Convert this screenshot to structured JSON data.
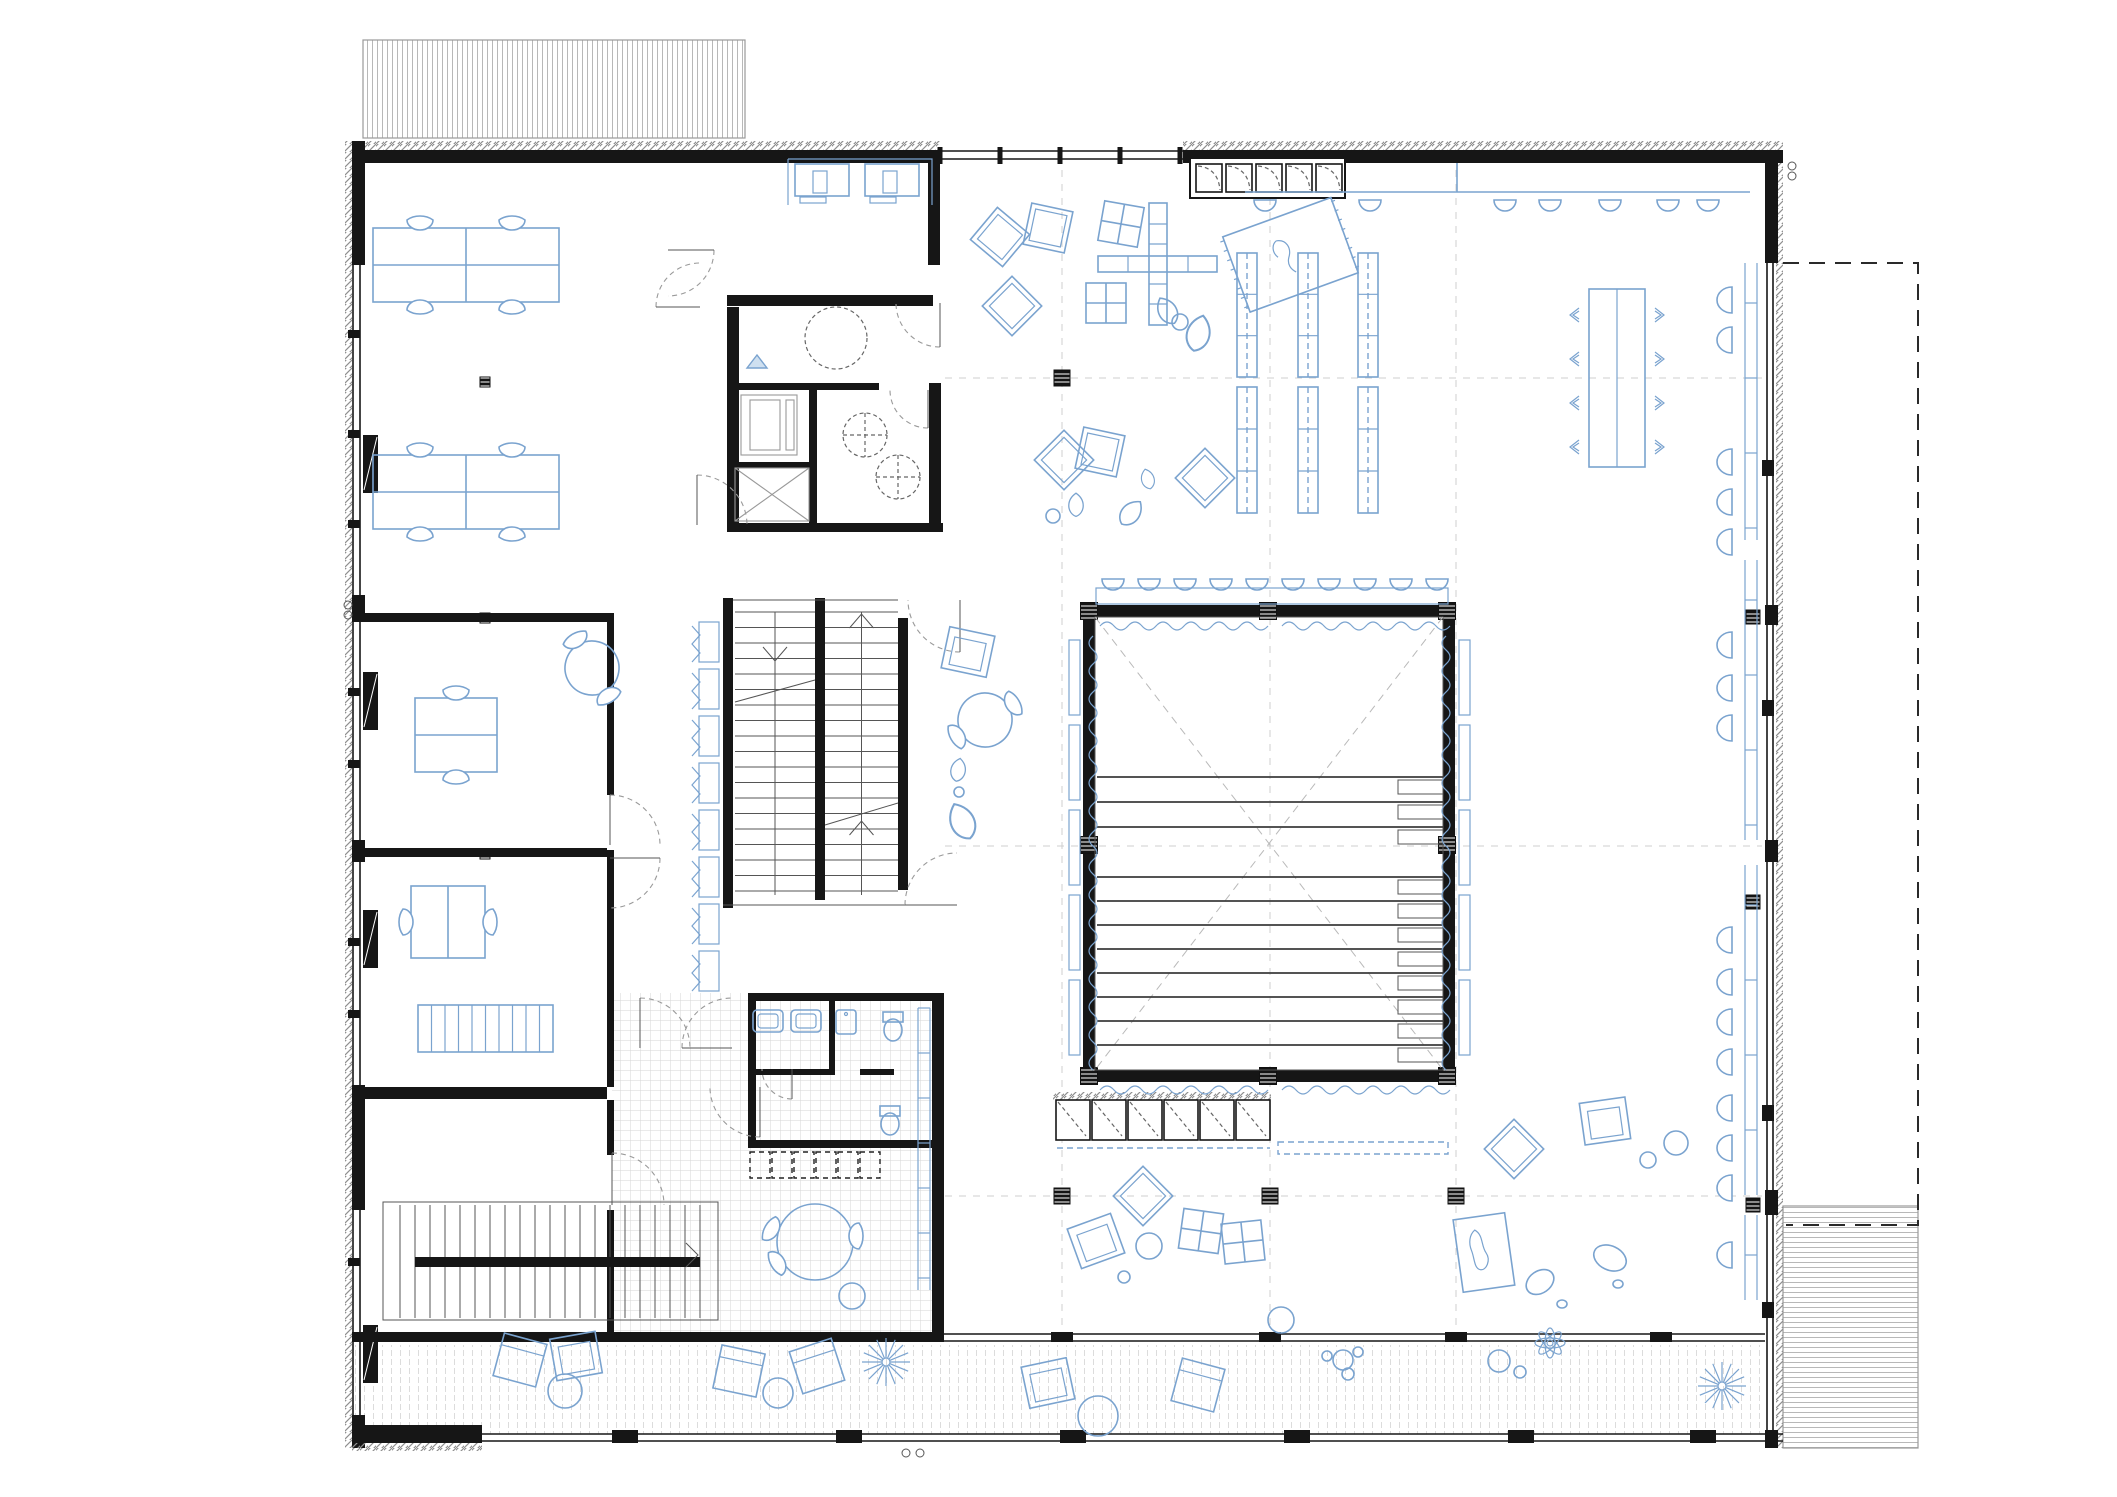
{
  "meta": {
    "drawing_type": "architectural floor plan",
    "text_on_drawing": "none",
    "style": "black walls, blue furniture line-work on white"
  },
  "colors": {
    "wall": "#161616",
    "furniture_line": "#7aa3cf",
    "hatch": "#8f8f8f",
    "tile": "#d6d6d6",
    "deck": "#dcdcdc",
    "grid": "#cfcfcf"
  },
  "zones": [
    {
      "id": "canopy-north",
      "bbox": [
        363,
        40,
        382,
        98
      ]
    },
    {
      "id": "classroom-northwest",
      "bbox": [
        363,
        163,
        340,
        450
      ]
    },
    {
      "id": "computer-room",
      "bbox": [
        712,
        163,
        228,
        140
      ]
    },
    {
      "id": "elevator-core",
      "bbox": [
        727,
        383,
        90,
        147
      ]
    },
    {
      "id": "wc-accessible",
      "bbox": [
        817,
        383,
        120,
        147
      ]
    },
    {
      "id": "meeting-room-a",
      "bbox": [
        363,
        623,
        250,
        225
      ]
    },
    {
      "id": "meeting-room-b",
      "bbox": [
        363,
        858,
        250,
        229
      ]
    },
    {
      "id": "storage-room-southwest",
      "bbox": [
        363,
        1100,
        245,
        100
      ]
    },
    {
      "id": "stair-southwest",
      "bbox": [
        383,
        1202,
        335,
        130
      ]
    },
    {
      "id": "main-staircase",
      "bbox": [
        723,
        598,
        185,
        310
      ]
    },
    {
      "id": "central-corridor",
      "bbox": [
        613,
        618,
        110,
        470
      ]
    },
    {
      "id": "cafe",
      "bbox": [
        612,
        1148,
        320,
        184
      ]
    },
    {
      "id": "wc-south",
      "bbox": [
        748,
        993,
        192,
        155
      ]
    },
    {
      "id": "library-north",
      "bbox": [
        945,
        200,
        820,
        400
      ]
    },
    {
      "id": "auditorium",
      "bbox": [
        1083,
        605,
        372,
        477
      ]
    },
    {
      "id": "lounge-south",
      "bbox": [
        945,
        1085,
        820,
        250
      ]
    },
    {
      "id": "lounge-east",
      "bbox": [
        1475,
        620,
        290,
        440
      ]
    },
    {
      "id": "terrace-south",
      "bbox": [
        352,
        1345,
        1413,
        92
      ]
    },
    {
      "id": "ramp-southeast",
      "bbox": [
        1783,
        1206,
        135,
        242
      ]
    },
    {
      "id": "plot-boundary-east",
      "bbox": [
        1783,
        263,
        135,
        962
      ]
    }
  ],
  "grid": {
    "vx": [
      1062,
      1270,
      1456
    ],
    "hy": [
      378,
      846,
      1196
    ],
    "xr": [
      945,
      1762
    ],
    "yr": [
      170,
      1335
    ]
  },
  "columns": {
    "large": [
      [
        1062,
        378
      ],
      [
        1062,
        1196
      ],
      [
        1270,
        1196
      ],
      [
        1456,
        1196
      ]
    ],
    "mini": [
      [
        485,
        382
      ],
      [
        485,
        618
      ],
      [
        485,
        854
      ]
    ],
    "facade": [
      [
        1753,
        617
      ],
      [
        1753,
        902
      ],
      [
        1753,
        1205
      ]
    ],
    "hall": [
      [
        1089,
        611
      ],
      [
        1268,
        611
      ],
      [
        1447,
        611
      ],
      [
        1089,
        845
      ],
      [
        1447,
        845
      ],
      [
        1089,
        1076
      ],
      [
        1268,
        1076
      ],
      [
        1447,
        1076
      ]
    ]
  },
  "auditorium": {
    "inner": [
      1095,
      617,
      348,
      453
    ],
    "rows_y": [
      777,
      802,
      827,
      877,
      901,
      925,
      949,
      973,
      997,
      1021,
      1045
    ],
    "row_x": [
      1097,
      1443
    ],
    "step": [
      1398,
      45,
      14
    ],
    "track": [
      1096,
      588,
      352,
      16
    ],
    "pendant_y": 579,
    "pendant_xs": [
      1113,
      1149,
      1185,
      1221,
      1257,
      1293,
      1329,
      1365,
      1401,
      1437
    ],
    "panel_ys": [
      640,
      725,
      810,
      895,
      980
    ],
    "panel_left_x": 1069,
    "panel_right_x": 1459,
    "curtains_h": [
      [
        1100,
        626,
        158
      ],
      [
        1282,
        626,
        158
      ],
      [
        1100,
        1090,
        158
      ],
      [
        1282,
        1090,
        158
      ]
    ],
    "curtains_v": [
      [
        1093,
        636,
        424
      ],
      [
        1446,
        636,
        424
      ]
    ],
    "cabinets": {
      "x": 1056,
      "y": 1100,
      "n": 6,
      "w": 36,
      "h": 40
    },
    "cabinet_hatch": [
      1053,
      1092,
      218,
      8
    ],
    "bench_dashed": [
      1278,
      1142,
      170,
      12
    ],
    "bench_line": [
      1057,
      1148,
      213
    ]
  },
  "stairs": {
    "main": {
      "lx": 735,
      "mx1": 815,
      "mx2": 825,
      "rx": 898,
      "y0": 612,
      "y1": 895,
      "step": 15.5
    },
    "south": {
      "x0": 400,
      "x1": 700,
      "y0": 1205,
      "y1": 1318,
      "step": 15,
      "rail": [
        415,
        1257,
        285,
        10
      ],
      "frame": [
        383,
        1202,
        335,
        118
      ]
    }
  },
  "library": {
    "shelf_xs": [
      1247,
      1308,
      1368
    ],
    "shelf_segs": [
      [
        253,
        124
      ],
      [
        387,
        126
      ]
    ],
    "shelf_w": 20,
    "lockers": {
      "x": 1196,
      "y": 164,
      "n": 5,
      "w": 26,
      "h": 28,
      "gap": 4,
      "frame": [
        1190,
        158,
        155,
        40
      ]
    },
    "counter": {
      "y": 192,
      "x0": 1245,
      "x1": 1750,
      "stub_x": 1457,
      "pendant_xs": [
        1265,
        1370,
        1505,
        1550,
        1610,
        1668,
        1708
      ],
      "pendant_y": 200
    },
    "colonnade": {
      "y1": 151,
      "y2": 159,
      "x0": 940,
      "x1": 1183,
      "ticks": [
        940,
        1000,
        1060,
        1120,
        1180
      ]
    }
  },
  "window_bench": {
    "x": 1727,
    "ys": [
      300,
      340,
      462,
      502,
      542,
      645,
      688,
      728,
      940,
      982,
      1022,
      1062,
      1108,
      1148,
      1188,
      1255
    ]
  },
  "window_counter": {
    "x1": 1745,
    "x2": 1757,
    "segs": [
      [
        263,
        540
      ],
      [
        560,
        840
      ],
      [
        865,
        1195
      ],
      [
        1215,
        1300
      ]
    ]
  },
  "corridor_bench": {
    "x": 699,
    "y0": 622,
    "n": 8,
    "step": 47
  },
  "cubbies": {
    "x": 750,
    "y": 1152,
    "n": 6,
    "w": 20,
    "h": 26,
    "gap": 2
  },
  "doors": [
    [
      700,
      307,
      44,
      180,
      270
    ],
    [
      940,
      303,
      44,
      90,
      180
    ],
    [
      928,
      390,
      38,
      90,
      180
    ],
    [
      697,
      525,
      50,
      270,
      360
    ],
    [
      960,
      600,
      52,
      90,
      180
    ],
    [
      957,
      905,
      52,
      180,
      270
    ],
    [
      610,
      845,
      50,
      270,
      360
    ],
    [
      610,
      858,
      50,
      0,
      90
    ],
    [
      612,
      1205,
      52,
      270,
      360
    ],
    [
      760,
      1087,
      50,
      90,
      180
    ],
    [
      792,
      1069,
      30,
      90,
      180
    ],
    [
      668,
      250,
      46,
      0,
      90
    ],
    [
      640,
      1048,
      50,
      270,
      360
    ],
    [
      732,
      1048,
      50,
      180,
      270
    ]
  ],
  "marks": {
    "circle_pairs": [
      [
        1792,
        166
      ],
      [
        348,
        605
      ],
      [
        906,
        1453
      ]
    ],
    "triangle": [
      757,
      368,
      20,
      13
    ],
    "dashed_circle": [
      836,
      338,
      31
    ],
    "wc_circles": [
      [
        865,
        435,
        22
      ],
      [
        898,
        477,
        22
      ]
    ]
  },
  "furniture": {
    "items": [
      {
        "t": "table4",
        "x": 466,
        "y": 265
      },
      {
        "t": "table4",
        "x": 466,
        "y": 492
      },
      {
        "t": "pcbay",
        "x": 860,
        "y": 183
      },
      {
        "t": "table2v",
        "x": 456,
        "y": 735
      },
      {
        "t": "round2",
        "x": 592,
        "y": 668,
        "rad": 27,
        "r": -30
      },
      {
        "t": "table2h",
        "x": 448,
        "y": 922
      },
      {
        "t": "shelf10",
        "x": 485,
        "y": 1028
      },
      {
        "t": "round3",
        "x": 815,
        "y": 1242,
        "rad": 38
      },
      {
        "t": "stool",
        "x": 852,
        "y": 1296,
        "rad": 13
      },
      {
        "t": "sink",
        "x": 768,
        "y": 1021
      },
      {
        "t": "sink",
        "x": 806,
        "y": 1021
      },
      {
        "t": "sinksm",
        "x": 846,
        "y": 1022
      },
      {
        "t": "toilet",
        "x": 893,
        "y": 1026
      },
      {
        "t": "toilet",
        "x": 890,
        "y": 1120
      },
      {
        "t": "diamond",
        "x": 1000,
        "y": 237,
        "r": 40
      },
      {
        "t": "diamond",
        "x": 1048,
        "y": 228,
        "r": 12
      },
      {
        "t": "diamond",
        "x": 1012,
        "y": 306,
        "r": 45
      },
      {
        "t": "diamond",
        "x": 1064,
        "y": 460,
        "r": 45
      },
      {
        "t": "diamond",
        "x": 1100,
        "y": 452,
        "r": 12
      },
      {
        "t": "diamond",
        "x": 1205,
        "y": 478,
        "r": 45
      },
      {
        "t": "blob",
        "x": 1168,
        "y": 312,
        "r": -30
      },
      {
        "t": "blob",
        "x": 1198,
        "y": 335,
        "r": 15,
        "s": 1.25
      },
      {
        "t": "blob",
        "x": 1076,
        "y": 506,
        "s": 0.8
      },
      {
        "t": "blob",
        "x": 1130,
        "y": 514,
        "r": 40
      },
      {
        "t": "blob",
        "x": 1148,
        "y": 480,
        "r": -15,
        "s": 0.7
      },
      {
        "t": "blob",
        "x": 958,
        "y": 771,
        "r": 10,
        "s": 0.8
      },
      {
        "t": "blob",
        "x": 963,
        "y": 823,
        "r": -25,
        "s": 1.3
      },
      {
        "t": "circle",
        "x": 1180,
        "y": 322,
        "rad": 8
      },
      {
        "t": "circle",
        "x": 1053,
        "y": 516,
        "rad": 7
      },
      {
        "t": "circle",
        "x": 959,
        "y": 792,
        "rad": 5
      },
      {
        "t": "armchair",
        "x": 968,
        "y": 652,
        "r": 12
      },
      {
        "t": "round2",
        "x": 985,
        "y": 720,
        "rad": 27,
        "r": 60
      },
      {
        "t": "cross",
        "x": 1158,
        "y": 264
      },
      {
        "t": "quad",
        "x": 1121,
        "y": 224,
        "r": 10
      },
      {
        "t": "quad",
        "x": 1106,
        "y": 303
      },
      {
        "t": "rug1",
        "x": 1290,
        "y": 255,
        "r": -20
      },
      {
        "t": "diamond",
        "x": 1143,
        "y": 1196,
        "r": 45
      },
      {
        "t": "diamond",
        "x": 1514,
        "y": 1149,
        "r": 45
      },
      {
        "t": "armchair",
        "x": 1096,
        "y": 1241,
        "r": -20
      },
      {
        "t": "armchair",
        "x": 1605,
        "y": 1121,
        "r": -8
      },
      {
        "t": "circle",
        "x": 1149,
        "y": 1246,
        "rad": 13
      },
      {
        "t": "circle",
        "x": 1124,
        "y": 1277,
        "rad": 6
      },
      {
        "t": "circle",
        "x": 1676,
        "y": 1143,
        "rad": 12
      },
      {
        "t": "circle",
        "x": 1648,
        "y": 1160,
        "rad": 8
      },
      {
        "t": "circle",
        "x": 1281,
        "y": 1320,
        "rad": 13
      },
      {
        "t": "quad",
        "x": 1201,
        "y": 1231,
        "r": 8
      },
      {
        "t": "quad",
        "x": 1243,
        "y": 1242,
        "r": -6
      },
      {
        "t": "rug2",
        "x": 1484,
        "y": 1253,
        "r": -8
      },
      {
        "t": "egg",
        "x": 1540,
        "y": 1282,
        "rx": 15,
        "ry": 11,
        "r": -35
      },
      {
        "t": "egg",
        "x": 1610,
        "y": 1258,
        "rx": 17,
        "ry": 12,
        "r": 25
      },
      {
        "t": "egg",
        "x": 1562,
        "y": 1304,
        "rx": 5,
        "ry": 4
      },
      {
        "t": "egg",
        "x": 1618,
        "y": 1284,
        "rx": 5,
        "ry": 4
      },
      {
        "t": "lounger",
        "x": 520,
        "y": 1360,
        "r": 15
      },
      {
        "t": "lounger",
        "x": 739,
        "y": 1371,
        "r": 12
      },
      {
        "t": "lounger",
        "x": 817,
        "y": 1366,
        "r": -18
      },
      {
        "t": "lounger",
        "x": 1198,
        "y": 1385,
        "r": 15
      },
      {
        "t": "armchair",
        "x": 576,
        "y": 1356,
        "r": -10
      },
      {
        "t": "armchair",
        "x": 1048,
        "y": 1383,
        "r": -12
      },
      {
        "t": "circle",
        "x": 565,
        "y": 1391,
        "rad": 17
      },
      {
        "t": "circle",
        "x": 778,
        "y": 1393,
        "rad": 15
      },
      {
        "t": "circle",
        "x": 1098,
        "y": 1416,
        "rad": 20
      },
      {
        "t": "tree",
        "x": 886,
        "y": 1362
      },
      {
        "t": "tree",
        "x": 1722,
        "y": 1386
      },
      {
        "t": "plant",
        "x": 1550,
        "y": 1343
      },
      {
        "t": "circle",
        "x": 1499,
        "y": 1361,
        "rad": 11
      },
      {
        "t": "circle",
        "x": 1520,
        "y": 1372,
        "rad": 6
      },
      {
        "t": "circle",
        "x": 1327,
        "y": 1356,
        "rad": 5
      },
      {
        "t": "circle",
        "x": 1343,
        "y": 1360,
        "rad": 10
      },
      {
        "t": "circle",
        "x": 1358,
        "y": 1352,
        "rad": 5
      },
      {
        "t": "circle",
        "x": 1348,
        "y": 1374,
        "rad": 6
      },
      {
        "t": "longtable",
        "x": 1617,
        "y": 378
      }
    ]
  }
}
